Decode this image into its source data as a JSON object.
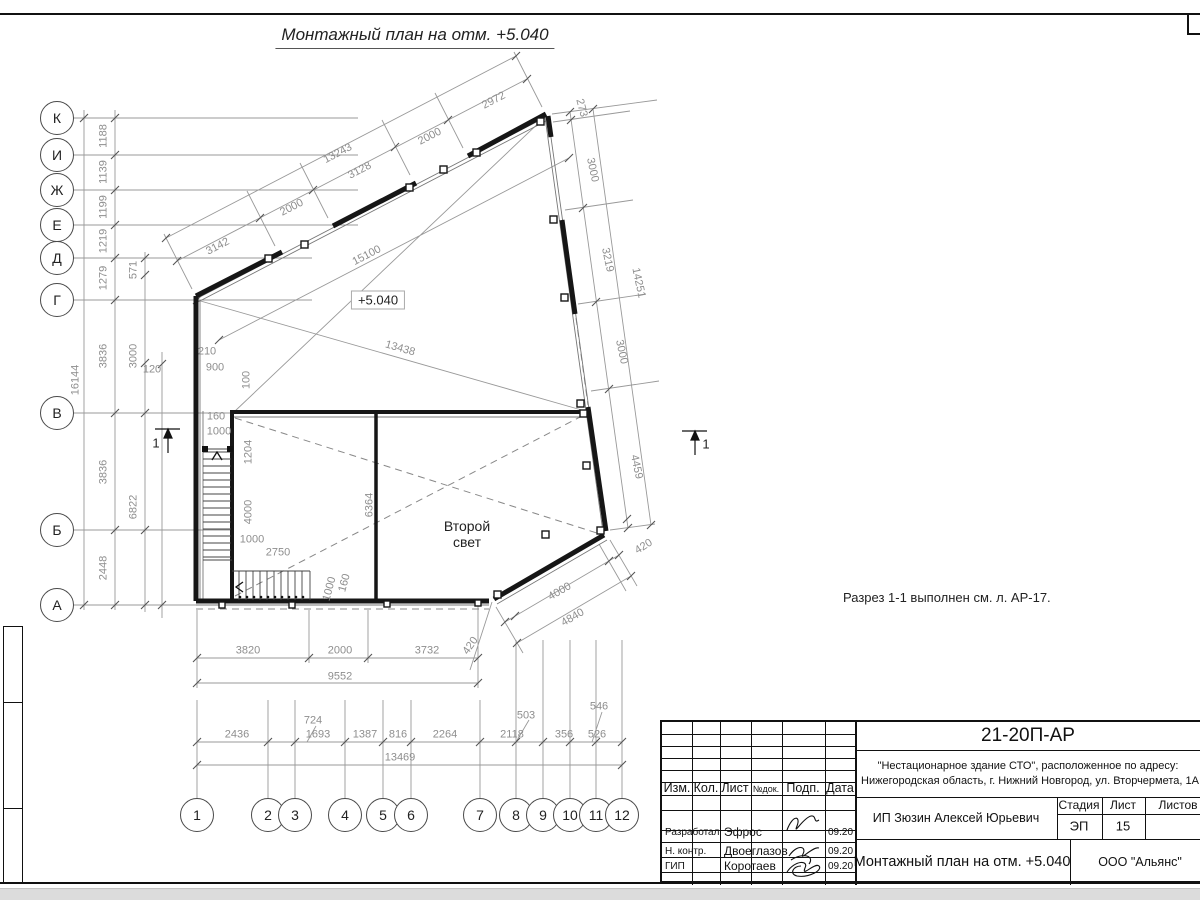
{
  "sheet": {
    "title": "Монтажный план на отм. +5.040",
    "elevation_label": "+5.040",
    "room_label": "Второй свет",
    "section_note": "Разрез 1-1 выполнен см. л. АР-17.",
    "section_mark": "1"
  },
  "axes": {
    "letters": [
      "К",
      "И",
      "Ж",
      "Е",
      "Д",
      "Г",
      "В",
      "Б",
      "А"
    ],
    "numbers": [
      "1",
      "2",
      "3",
      "4",
      "5",
      "6",
      "7",
      "8",
      "9",
      "10",
      "11",
      "12"
    ]
  },
  "dims": {
    "left_total": "16144",
    "left2": [
      "1188",
      "1139",
      "1199",
      "1219",
      "1279",
      "3836",
      "3836",
      "2448"
    ],
    "left3": [
      "571",
      "3000",
      "6822"
    ],
    "v120": "120",
    "near": [
      "210",
      "900",
      "100",
      "160",
      "1000",
      "1204",
      "4000",
      "1000",
      "2750",
      "1000",
      "160"
    ],
    "inner": [
      "6364",
      "13438",
      "15100"
    ],
    "top": [
      "3142",
      "2000",
      "3128",
      "2000",
      "2972",
      "13243"
    ],
    "right": [
      "273",
      "3000",
      "3219",
      "3000",
      "14251",
      "4459",
      "420"
    ],
    "br": [
      "4000",
      "4840"
    ],
    "bot1": [
      "3820",
      "2000",
      "3732",
      "420",
      "9552"
    ],
    "bot2": [
      "2436",
      "724",
      "1693",
      "1387",
      "816",
      "2264",
      "2118",
      "503",
      "356",
      "546",
      "526",
      "13469"
    ]
  },
  "titleblock": {
    "doc_number": "21-20П-АР",
    "project_line1": "\"Нестационарное здание СТО\", расположенное по адресу:",
    "project_line2": "Нижегородская область, г. Нижний Новгород, ул. Вторчермета, 1А",
    "header": {
      "izm": "Изм.",
      "kol": "Кол.",
      "list": "Лист",
      "ndok": "№док.",
      "podp": "Подп.",
      "data": "Дата"
    },
    "rows": [
      {
        "role": "Разработал",
        "name": "Эфрос",
        "date": "09.20"
      },
      {
        "role": "Н. контр.",
        "name": "Двоеглазов",
        "date": "09.20"
      },
      {
        "role": "ГИП",
        "name": "Коротаев",
        "date": "09.20"
      }
    ],
    "client": "ИП Зюзин Алексей Юрьевич",
    "stage_label": "Стадия",
    "sheet_label": "Лист",
    "sheets_label": "Листов",
    "stage": "ЭП",
    "sheet_no": "15",
    "drawing_name": "Монтажный план на отм. +5.040",
    "company": "ООО \"Альянс\""
  }
}
